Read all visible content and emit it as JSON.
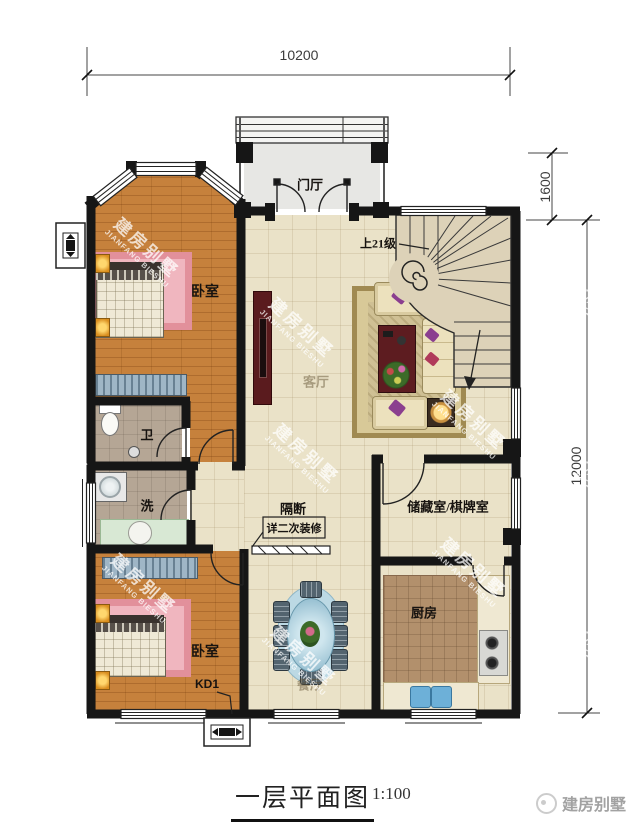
{
  "dimensions": {
    "overall_width": "10200",
    "porch_depth": "1600",
    "overall_depth": "12000"
  },
  "rooms": {
    "entry": "门厅",
    "stairs_note": "上21级",
    "bedroom_top": "卧室",
    "living": "客厅",
    "toilet": "卫",
    "wash": "洗",
    "partition": "隔断",
    "partition_note": "详二次装修",
    "storage": "储藏室/棋牌室",
    "bedroom_bottom": "卧室",
    "kd_label": "KD1",
    "dining": "餐厅",
    "kitchen": "厨房"
  },
  "footer": {
    "title": "一层平面图",
    "scale": "1:100",
    "brand": "建房别墅"
  },
  "watermark": {
    "cn": "建房别墅",
    "en": "JIANFANG BIESHU"
  },
  "colors": {
    "wall": "#161616",
    "wood_floor": "#c6813c",
    "tile_floor": "#eae2c8",
    "bath_floor": "#b5a695",
    "kitchen_floor": "#b2906c",
    "porch_floor": "#e7e7e4",
    "stair_fill": "#ddd2b8",
    "rug_pink": "#e2909b",
    "rug_gold": "#cfc094",
    "dining_table_blue": "#bcd9e4",
    "accent_dark_red": "#5d1c20"
  }
}
